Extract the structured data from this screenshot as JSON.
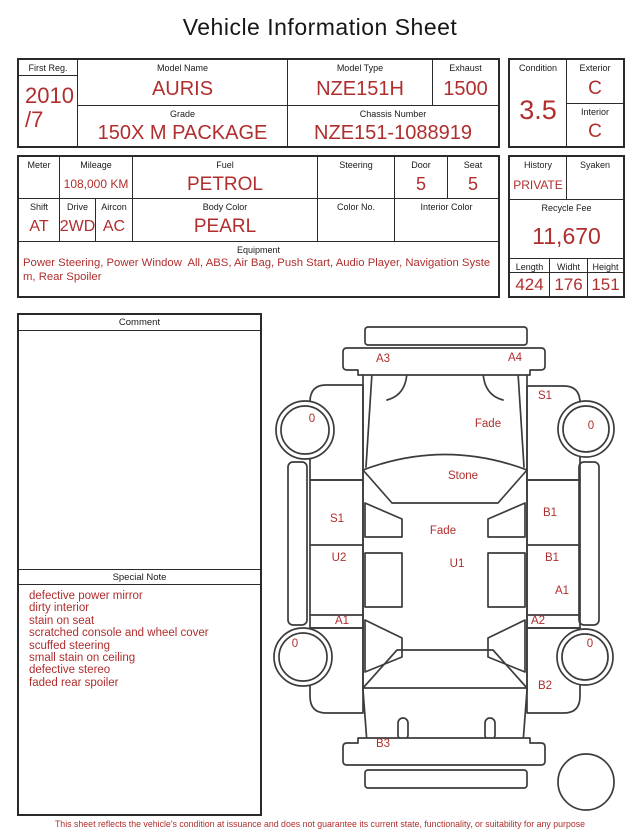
{
  "title": "Vehicle Information Sheet",
  "colors": {
    "accent_red": "#b02e2e",
    "border": "#2a2a2a",
    "background": "#ffffff"
  },
  "header_table": {
    "first_reg": {
      "label": "First Reg.",
      "value_line1": "2010",
      "value_line2": "/7"
    },
    "model_name": {
      "label": "Model Name",
      "value": "AURIS"
    },
    "model_type": {
      "label": "Model Type",
      "value": "NZE151H"
    },
    "exhaust": {
      "label": "Exhaust",
      "value": "1500"
    },
    "grade": {
      "label": "Grade",
      "value": "150X M PACKAGE"
    },
    "chassis_number": {
      "label": "Chassis Number",
      "value": "NZE151-1088919"
    },
    "condition": {
      "label": "Condition",
      "value": "3.5"
    },
    "exterior": {
      "label": "Exterior",
      "value": "C"
    },
    "interior": {
      "label": "Interior",
      "value": "C"
    }
  },
  "spec_table": {
    "meter": {
      "label": "Meter",
      "value": ""
    },
    "mileage": {
      "label": "Mileage",
      "value": "108,000 KM"
    },
    "fuel": {
      "label": "Fuel",
      "value": "PETROL"
    },
    "steering": {
      "label": "Steering",
      "value": ""
    },
    "door": {
      "label": "Door",
      "value": "5"
    },
    "seat": {
      "label": "Seat",
      "value": "5"
    },
    "shift": {
      "label": "Shift",
      "value": "AT"
    },
    "drive": {
      "label": "Drive",
      "value": "2WD"
    },
    "aircon": {
      "label": "Aircon",
      "value": "AC"
    },
    "body_color": {
      "label": "Body Color",
      "value": "PEARL"
    },
    "color_no": {
      "label": "Color No.",
      "value": ""
    },
    "interior_color": {
      "label": "Interior Color",
      "value": ""
    },
    "equipment": {
      "label": "Equipment",
      "value": "Power Steering, Power Window  All, ABS, Air Bag, Push Start, Audio Player, Navigation System, Rear Spoiler"
    },
    "history": {
      "label": "History",
      "value": "PRIVATE"
    },
    "syaken": {
      "label": "Syaken",
      "value": ""
    },
    "recycle_fee": {
      "label": "Recycle Fee",
      "value": "11,670"
    },
    "length": {
      "label": "Length",
      "value": "424"
    },
    "width": {
      "label": "Widht",
      "value": "176"
    },
    "height": {
      "label": "Height",
      "value": "151"
    }
  },
  "comment": {
    "label": "Comment",
    "value": ""
  },
  "special_note": {
    "label": "Special Note",
    "items": [
      "defective power mirror",
      "dirty interior",
      "stain on seat",
      "scratched console and wheel cover",
      "scuffed steering",
      "small stain on ceiling",
      "defective stereo",
      "faded rear spoiler"
    ]
  },
  "diagram": {
    "labels": [
      {
        "text": "A3",
        "x": 115,
        "y": 49
      },
      {
        "text": "A4",
        "x": 247,
        "y": 48
      },
      {
        "text": "S1",
        "x": 277,
        "y": 86
      },
      {
        "text": "0",
        "x": 44,
        "y": 109
      },
      {
        "text": "Fade",
        "x": 220,
        "y": 114
      },
      {
        "text": "0",
        "x": 323,
        "y": 116
      },
      {
        "text": "Stone",
        "x": 195,
        "y": 166
      },
      {
        "text": "S1",
        "x": 69,
        "y": 209
      },
      {
        "text": "B1",
        "x": 282,
        "y": 203
      },
      {
        "text": "Fade",
        "x": 175,
        "y": 221
      },
      {
        "text": "U2",
        "x": 71,
        "y": 248
      },
      {
        "text": "U1",
        "x": 189,
        "y": 254
      },
      {
        "text": "B1",
        "x": 284,
        "y": 248
      },
      {
        "text": "A1",
        "x": 294,
        "y": 281
      },
      {
        "text": "A1",
        "x": 74,
        "y": 311
      },
      {
        "text": "A2",
        "x": 270,
        "y": 311
      },
      {
        "text": "0",
        "x": 27,
        "y": 334
      },
      {
        "text": "0",
        "x": 322,
        "y": 334
      },
      {
        "text": "B2",
        "x": 277,
        "y": 376
      },
      {
        "text": "B3",
        "x": 115,
        "y": 434
      }
    ]
  },
  "footer": "This sheet reflects the vehicle's condition at issuance and does not guarantee its current state, functionality, or suitability for any purpose"
}
